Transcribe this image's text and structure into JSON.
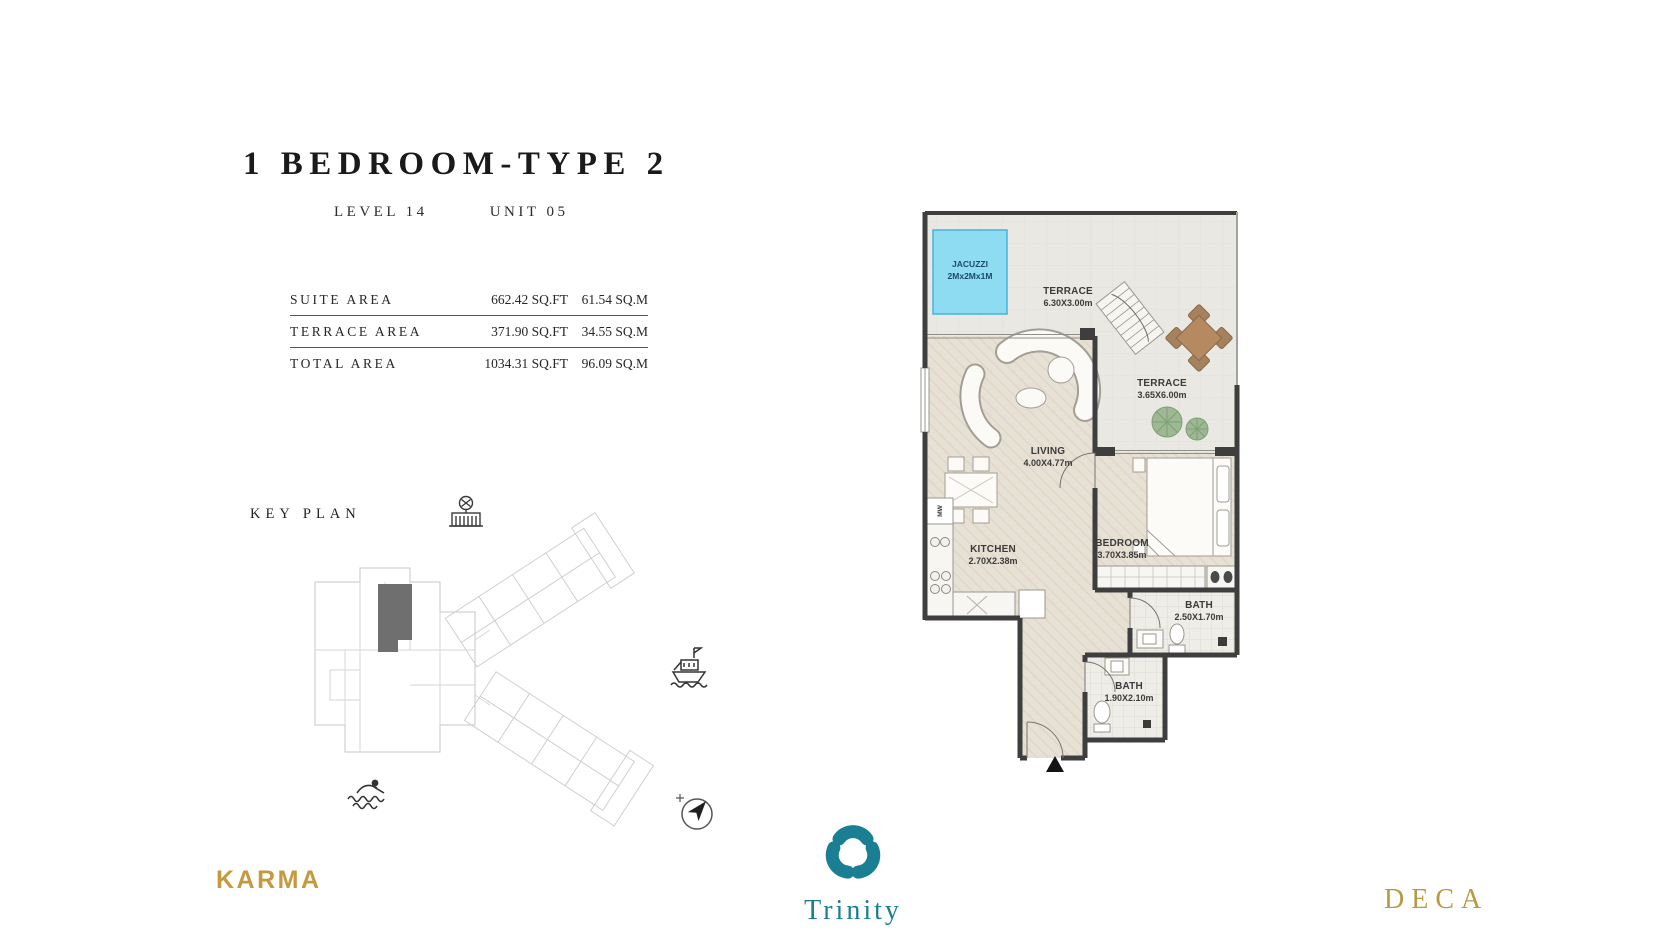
{
  "header": {
    "title": "1 BEDROOM-TYPE 2",
    "level": "LEVEL 14",
    "unit": "UNIT 05"
  },
  "area_table": {
    "rows": [
      {
        "label": "SUITE AREA",
        "sqft": "662.42 SQ.FT",
        "sqm": "61.54  SQ.M"
      },
      {
        "label": "TERRACE AREA",
        "sqft": "371.90 SQ.FT",
        "sqm": "34.55  SQ.M"
      },
      {
        "label": "TOTAL AREA",
        "sqft": "1034.31 SQ.FT",
        "sqm": "96.09  SQ.M"
      }
    ]
  },
  "key_plan": {
    "title": "KEY PLAN",
    "highlight_color": "#6f6f6f",
    "icons": [
      "building-icon",
      "ship-icon",
      "swimmer-icon",
      "compass-icon"
    ]
  },
  "floor_plan": {
    "jacuzzi": {
      "name": "JACUZZI",
      "dims": "2Mx2Mx1M",
      "color": "#8edcf2"
    },
    "terrace_top": {
      "name": "TERRACE",
      "dims": "6.30X3.00m"
    },
    "terrace_side": {
      "name": "TERRACE",
      "dims": "3.65X6.00m"
    },
    "living": {
      "name": "LIVING",
      "dims": "4.00X4.77m"
    },
    "kitchen": {
      "name": "KITCHEN",
      "dims": "2.70X2.38m"
    },
    "bedroom": {
      "name": "BEDROOM",
      "dims": "3.70X3.85m"
    },
    "bath1": {
      "name": "BATH",
      "dims": "2.50X1.70m"
    },
    "bath2": {
      "name": "BATH",
      "dims": "1.90X2.10m"
    },
    "microwave": "MW",
    "wall_color": "#3e3e3e",
    "floor_color": "#e7e0d4",
    "terrace_color": "#e9e8e2"
  },
  "brands": {
    "karma": {
      "label": "KARMA",
      "color": "#c49a3e"
    },
    "trinity": {
      "label": "Trinity",
      "color": "#1b7f93"
    },
    "deca": {
      "label": "DECA",
      "color": "#b89944"
    }
  }
}
